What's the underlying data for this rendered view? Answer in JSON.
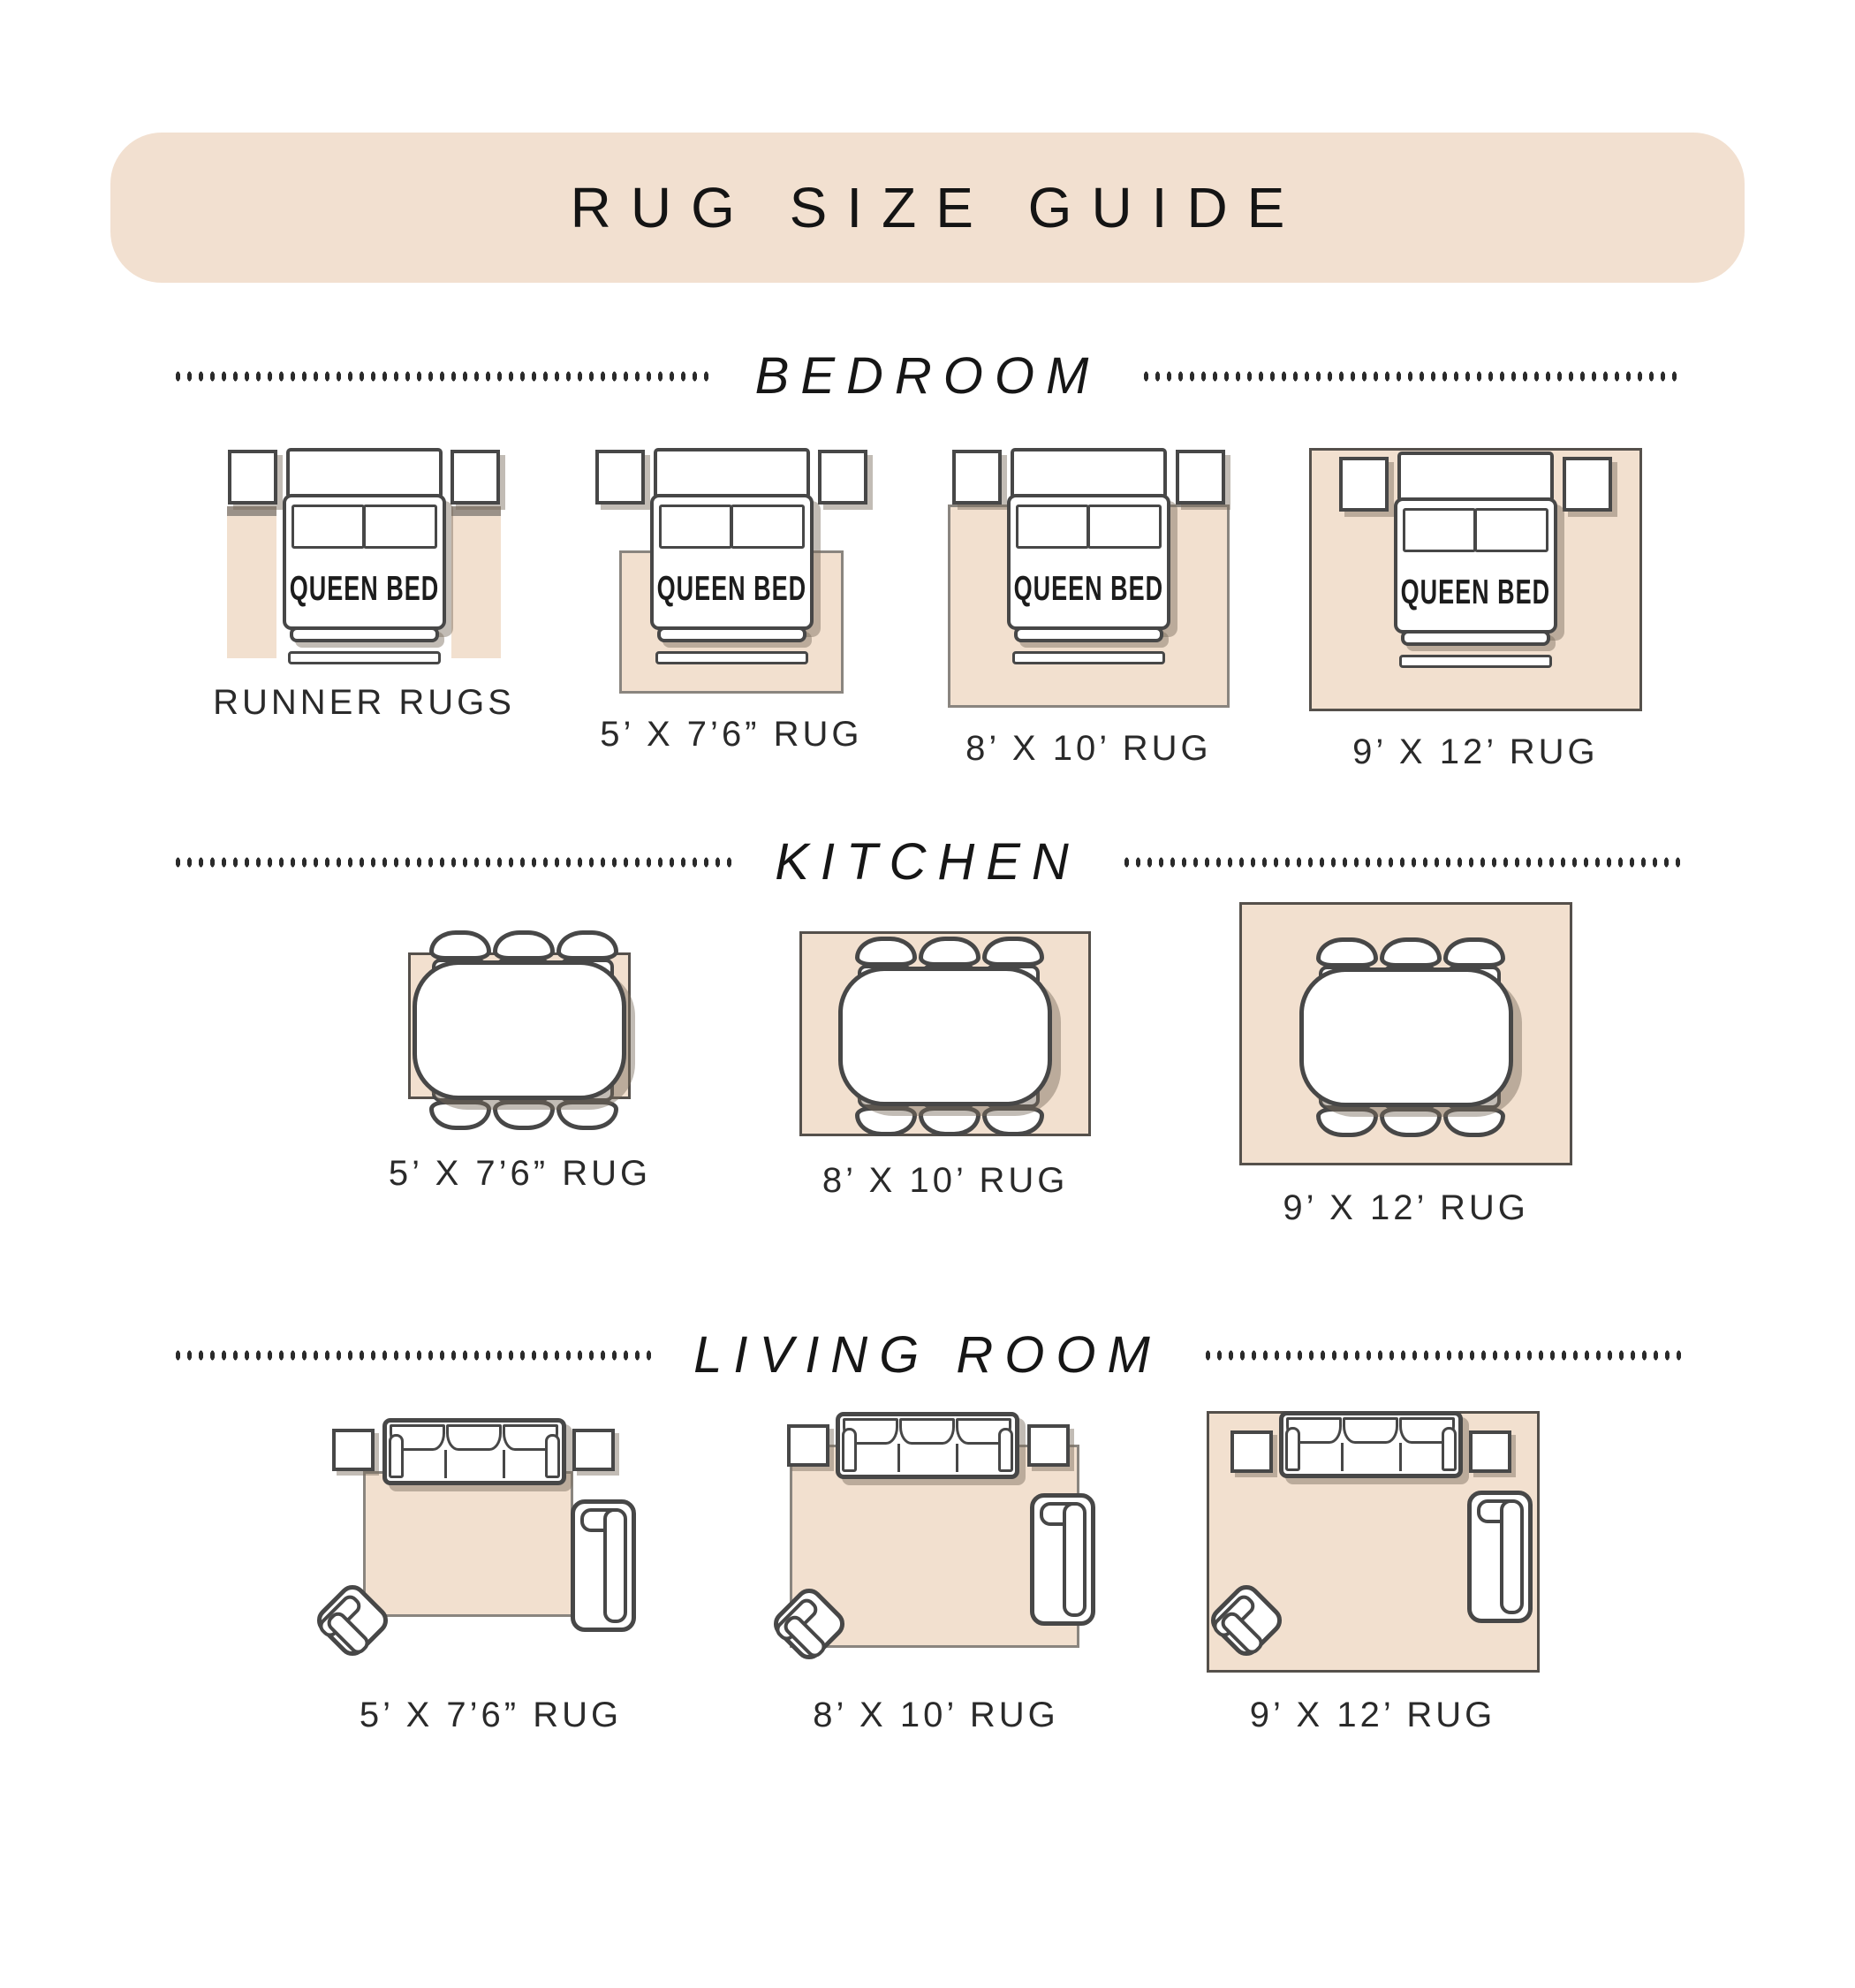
{
  "title": "RUG SIZE GUIDE",
  "bed_label": "QUEEN BED",
  "colors": {
    "rug": "#f2e0cf",
    "banner": "#f2e0d0",
    "outline": "#474747",
    "dot": "#2a2a2a",
    "shadow": "rgba(120,106,92,0.45)",
    "rug-border-light": "#8a857f",
    "rug-border-dark": "#55504b"
  },
  "sections": [
    {
      "label": "BEDROOM",
      "figures": [
        {
          "label": "RUNNER RUGS"
        },
        {
          "label": "5’ X 7’6” RUG"
        },
        {
          "label": "8’ X 10’ RUG"
        },
        {
          "label": "9’ X 12’ RUG"
        }
      ]
    },
    {
      "label": "KITCHEN",
      "figures": [
        {
          "label": "5’ X 7’6” RUG"
        },
        {
          "label": "8’ X 10’ RUG"
        },
        {
          "label": "9’ X 12’ RUG"
        }
      ]
    },
    {
      "label": "LIVING ROOM",
      "figures": [
        {
          "label": "5’ X 7’6” RUG"
        },
        {
          "label": "8’ X 10’ RUG"
        },
        {
          "label": "9’ X 12’ RUG"
        }
      ]
    }
  ]
}
